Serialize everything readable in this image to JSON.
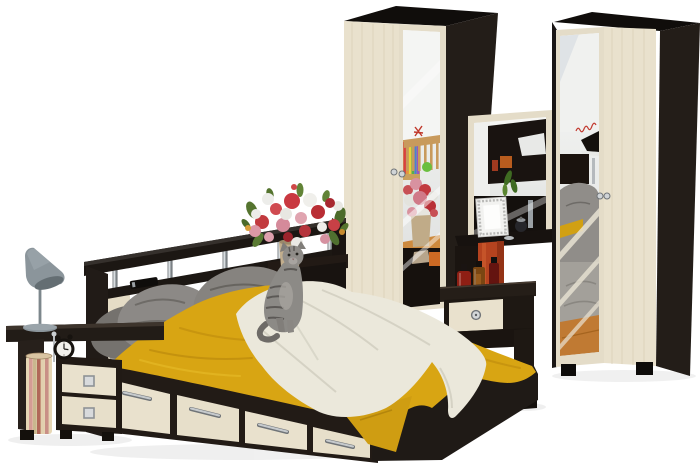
{
  "image": {
    "type": "product-photo",
    "alt": "Studio photo of a bedroom furniture set in dark wenge and cream oak: double bed with storage drawers, grey pillows, yellow blanket and white throw, headboard shelf with chrome posts, two mirrored wardrobes, dressing table with mirror, nightstands, grey cone table lamp, alarm clock, striped basket, vase of red and pink flowers, and a grey tabby cat",
    "background": "#ffffff"
  },
  "palette": {
    "background": "#ffffff",
    "wenge": "#221b16",
    "wenge_deep": "#17110d",
    "wenge_top": "#100d0b",
    "cream": "#e9e1cd",
    "cream_grain": "#d9cfb6",
    "mirror_light": "#f6f7f5",
    "mirror_shade": "#dcdedd",
    "yellow_blanket": "#d8a513",
    "yellow_shadow": "#b8860b",
    "throw_white": "#ebe8db",
    "throw_shadow": "#d5d2c4",
    "pillow_gray": "#8c8986",
    "pillow_dark": "#6f6c68",
    "chrome": "#c6cacd",
    "lamp_gray": "#8b959b",
    "flower_red": "#c23a3e",
    "flower_pink": "#dc98a6",
    "flower_white": "#ededea",
    "leaf_green": "#55742f",
    "vase_beige": "#c2ae8d",
    "accent_rust": "#b5431f",
    "wood_floor": "#c07a33",
    "script_red": "#c23a30"
  },
  "objects": {
    "left_nightstand": {
      "label": "open wenge nightstand with two cream drawers, striped basket and alarm clock",
      "drawer_count": 2
    },
    "table_lamp": {
      "label": "grey cone designer table lamp"
    },
    "alarm_clock": {
      "label": "black round alarm clock"
    },
    "bed": {
      "label": "double bed with four storage drawers, grey pillows, yellow blanket and white throw",
      "drawer_count": 4
    },
    "headboard_shelf": {
      "label": "headboard shelf with chrome posts and remote control"
    },
    "flower_vase": {
      "label": "beige vase with red, pink and white flowers"
    },
    "cat": {
      "label": "grey tabby cat sitting on the bed"
    },
    "left_wardrobe": {
      "label": "two-door wardrobe, cream door and mirror door, wenge side"
    },
    "right_wardrobe": {
      "label": "two-door wardrobe, mirror door and cream door, wenge side"
    },
    "vanity": {
      "label": "dressing table with framed mirror, photo frame, jar and perfume bottles"
    },
    "vanity_drawer_unit": {
      "label": "drawer unit with cream drawer and round knob"
    }
  }
}
